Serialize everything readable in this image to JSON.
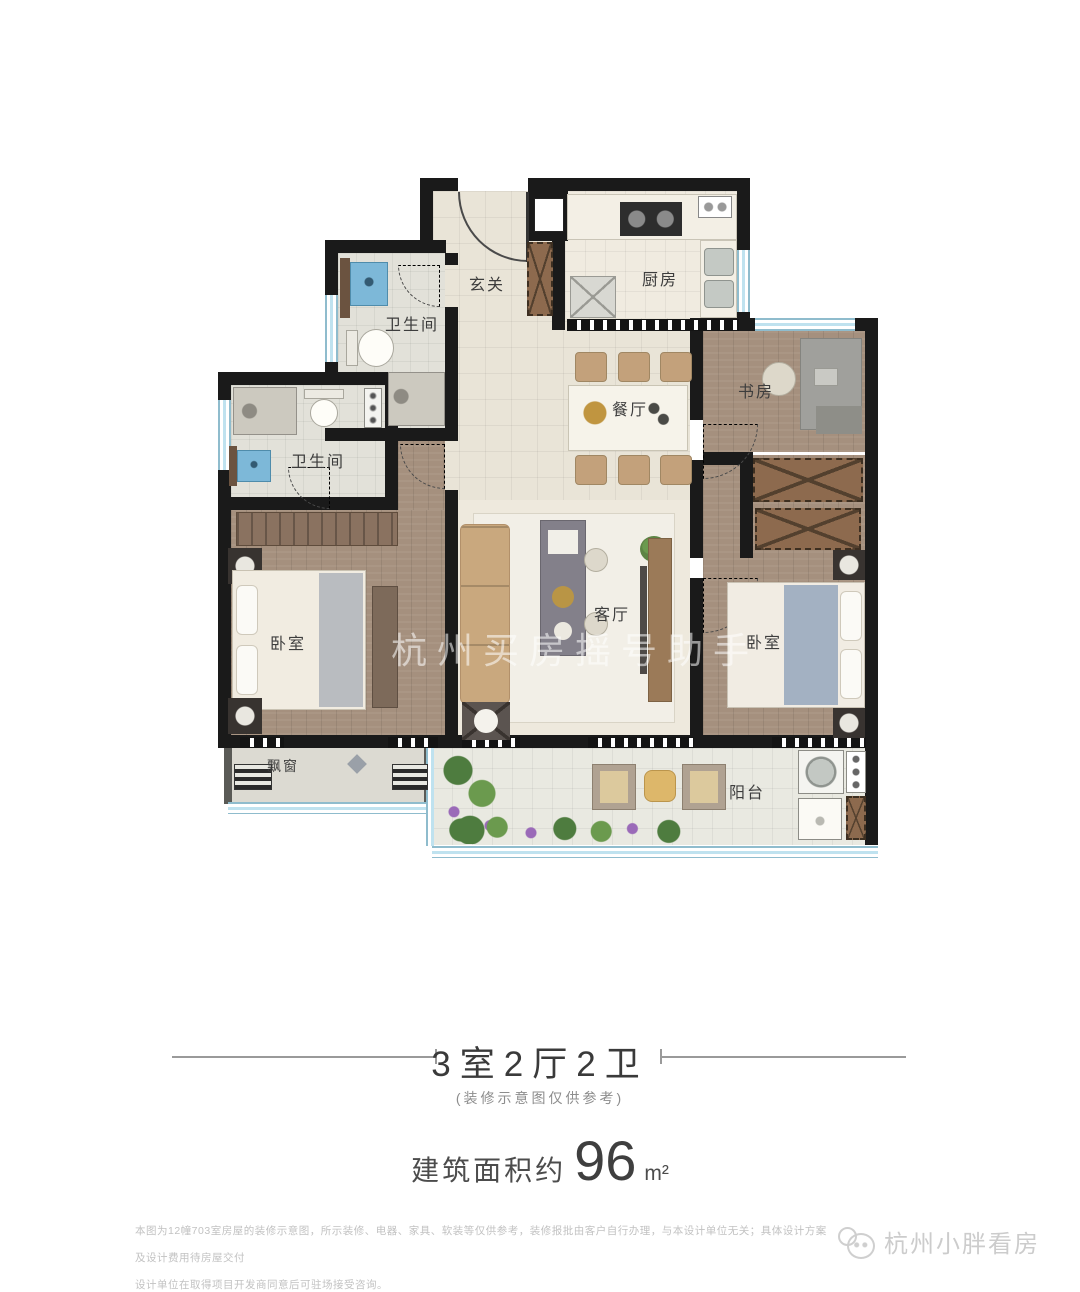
{
  "floorplan": {
    "rooms": {
      "entrance": "玄关",
      "kitchen": "厨房",
      "bath1": "卫生间",
      "bath2": "卫生间",
      "dining": "餐厅",
      "study": "书房",
      "living": "客厅",
      "bedroom_left": "卧室",
      "bedroom_right": "卧室",
      "bay_window": "飘窗",
      "balcony": "阳台"
    },
    "watermark_center": "杭州买房摇号助手"
  },
  "caption": {
    "title": "3室2厅2卫",
    "subtitle": "(装修示意图仅供参考)",
    "area_prefix": "建筑面积约",
    "area_value": "96",
    "area_unit": "m²"
  },
  "footer": {
    "disclaimer_line1": "本图为12幢703室房屋的装修示意图，所示装修、电器、家具、软装等仅供参考，装修报批由客户自行办理，与本设计单位无关；具体设计方案及设计费用待房屋交付",
    "disclaimer_line2": "设计单位在取得项目开发商同意后可驻场接受咨询。",
    "watermark": "杭州小胖看房"
  },
  "colors": {
    "wall": "#1a1a1a",
    "window": "#bfe2ef",
    "wood_floor": "#a5907e",
    "sofa": "#c9a87e",
    "wardrobe": "#8d6a4e",
    "vanity_blue": "#7db8d8"
  }
}
